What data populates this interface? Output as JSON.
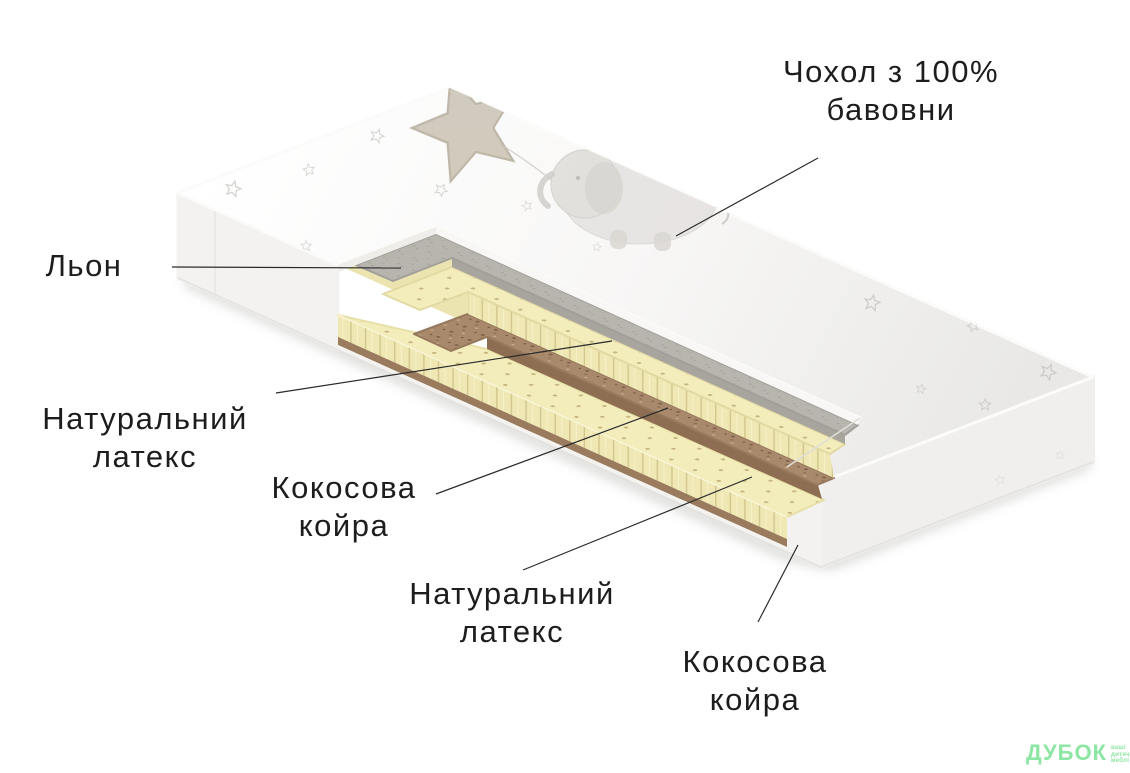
{
  "diagram": {
    "labels": {
      "cover": "Чохол з 100% бавовни",
      "linen": "Льон",
      "latex_top": "Натуральний\nлатекс",
      "coir_top": "Кокосова\nкойра",
      "latex_bottom": "Натуральний\nлатекс",
      "coir_bottom": "Кокосова\nкойра"
    },
    "layer_order_top_to_bottom": [
      "Чохол з 100% бавовни",
      "Льон",
      "Натуральний латекс",
      "Кокосова койра",
      "Натуральний латекс",
      "Кокосова койра"
    ]
  },
  "logo": {
    "brand": "ДУБОК",
    "tagline": "ваші\nдитячі\nмеблі"
  },
  "colors": {
    "label_text": "#1d1d1d",
    "leader_line": "#2b2b2b",
    "logo_green": "#8de6a3",
    "cover_white": "#fcfcfb",
    "linen_gray": "#b7b4ae",
    "latex_yellow": "#f3edbc",
    "coir_brown": "#a8896b"
  }
}
